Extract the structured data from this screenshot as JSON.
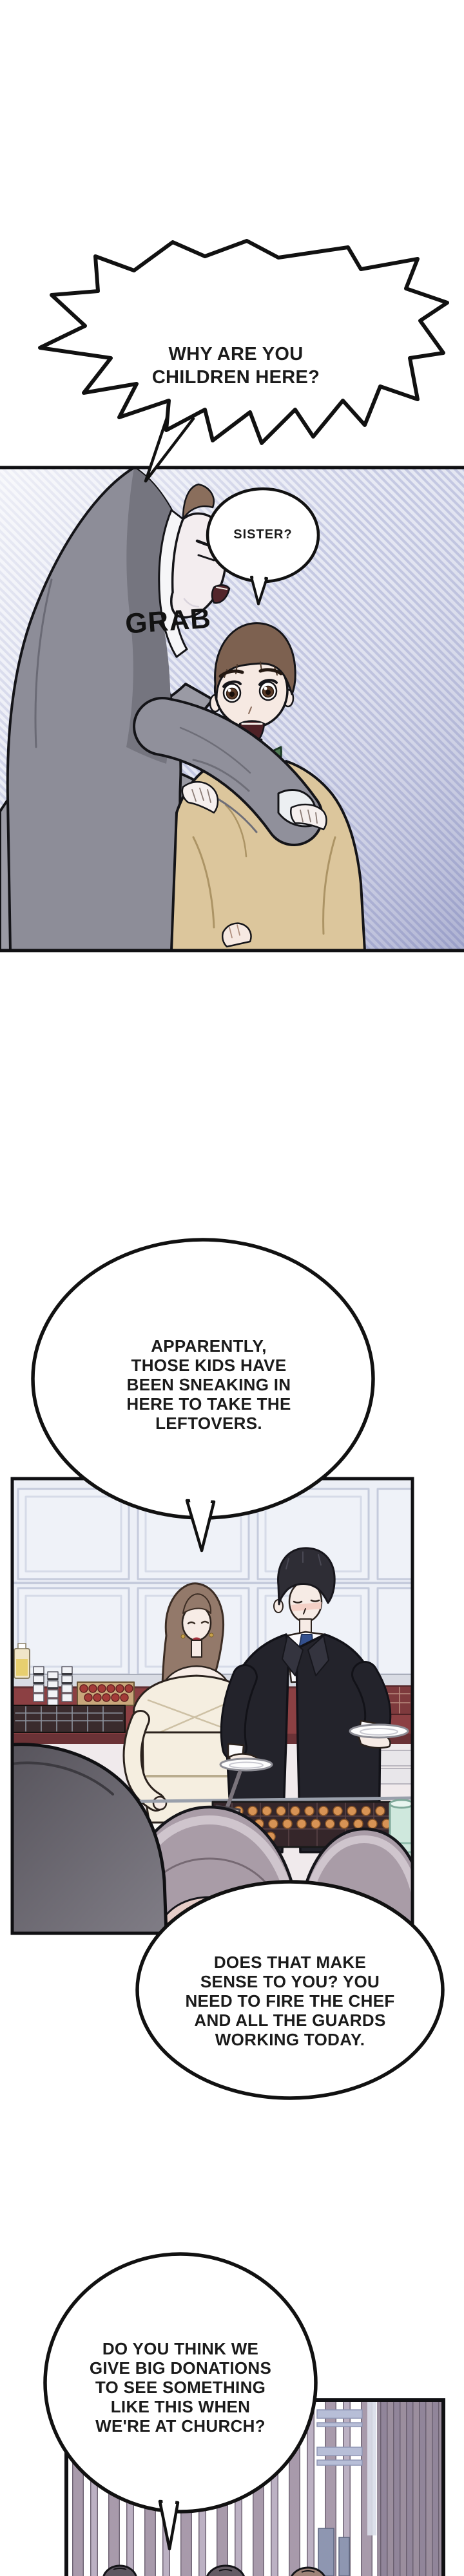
{
  "bubbles": {
    "scream": {
      "text": "WHY ARE YOU\nCHILDREN HERE?"
    },
    "sister": {
      "text": "SISTER?"
    },
    "apparently": {
      "text": "APPARENTLY,\nTHOSE KIDS HAVE\nBEEN SNEAKING IN\nHERE TO TAKE THE\nLEFTOVERS."
    },
    "fire": {
      "text": "DOES THAT MAKE\nSENSE TO YOU? YOU\nNEED TO FIRE THE CHEF\nAND ALL THE GUARDS\nWORKING TODAY."
    },
    "church": {
      "text": "DO YOU THINK WE\nGIVE BIG DONATIONS\nTO SEE SOMETHING\nLIKE THIS WHEN\nWE'RE AT CHURCH?"
    }
  },
  "sfx": {
    "grab": "GRAB"
  },
  "palette": {
    "ink": "#141418",
    "panel1_stripe": "#b4b9da",
    "nun_veil": "#8d8d98",
    "boy_jacket": "#dcc69c",
    "boy_collar": "#507c55",
    "counter_maroon": "#8c4043",
    "suit_black": "#23232b",
    "tie_navy": "#33508e",
    "dress_cream": "#f5eee0",
    "lid_mauve": "#a99ca7",
    "glass_mint": "#cfe8dd",
    "curtain_mauve": "#a89aab"
  }
}
